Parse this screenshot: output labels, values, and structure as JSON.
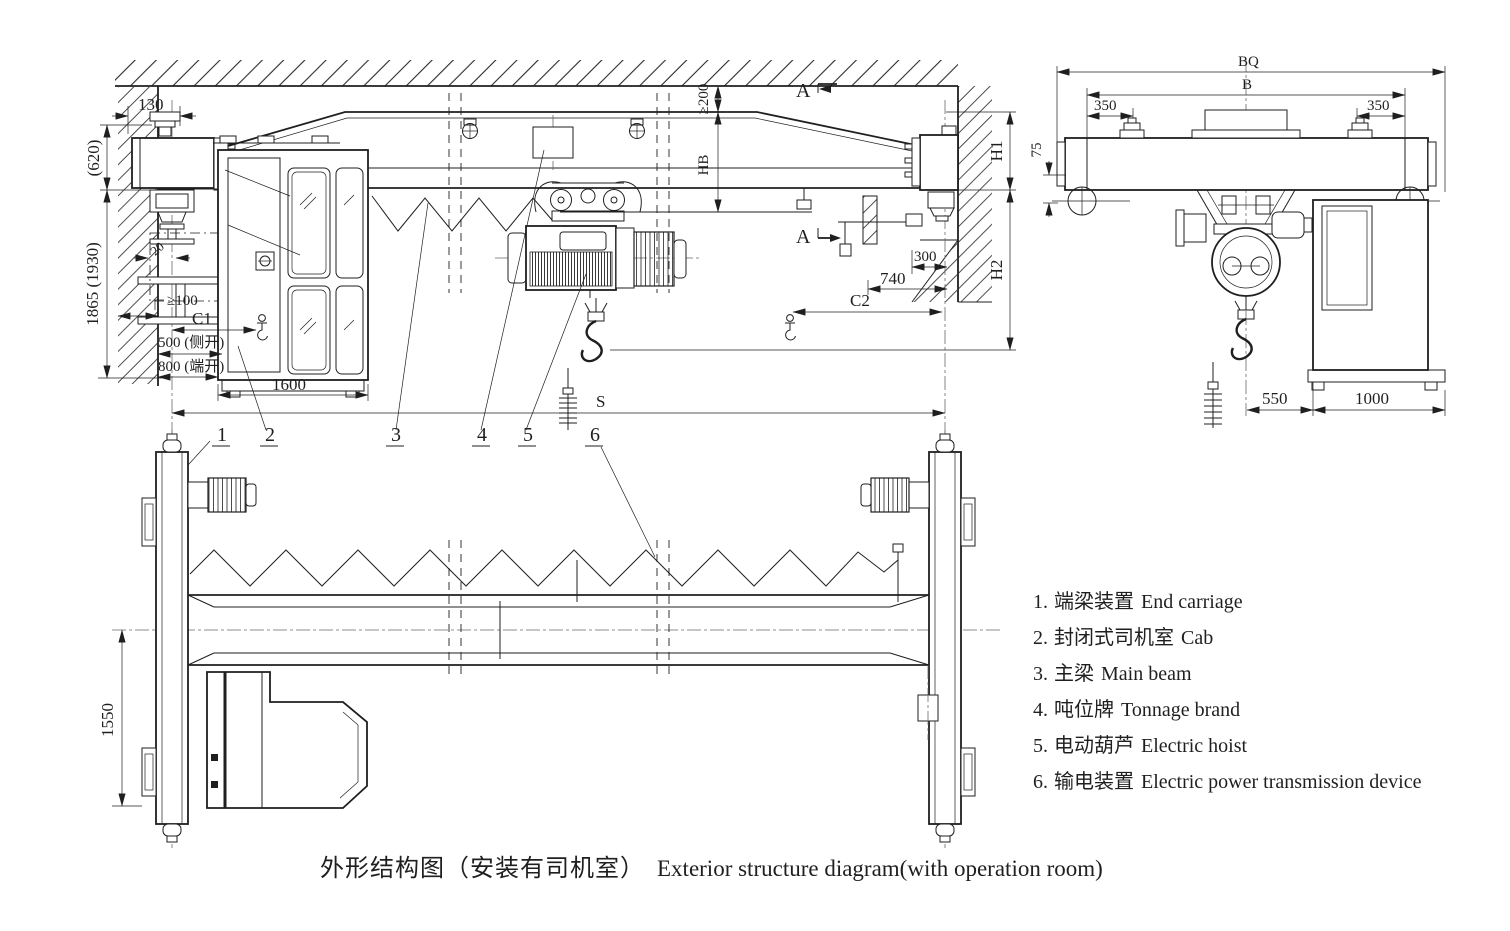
{
  "colors": {
    "ink": "#1f1f1f",
    "bg": "#ffffff"
  },
  "caption": {
    "zh": "外形结构图（安装有司机室）",
    "en": "Exterior structure diagram(with operation room)"
  },
  "legend": {
    "items": [
      {
        "num": "1.",
        "zh": "端梁装置",
        "en": "End carriage"
      },
      {
        "num": "2.",
        "zh": "封闭式司机室",
        "en": "Cab"
      },
      {
        "num": "3.",
        "zh": "主梁",
        "en": "Main beam"
      },
      {
        "num": "4.",
        "zh": "吨位牌",
        "en": "Tonnage brand"
      },
      {
        "num": "5.",
        "zh": "电动葫芦",
        "en": "Electric hoist"
      },
      {
        "num": "6.",
        "zh": "输电装置",
        "en": "Electric power transmission device"
      }
    ]
  },
  "front_view": {
    "dims": {
      "d130": "130",
      "d620": "(620)",
      "d1865": "1865 (1930)",
      "d20": "20",
      "dge100": "≥100",
      "dc1": "C1",
      "d500": "500 (侧开)",
      "d800": "800 (端开)",
      "d1600": "1600",
      "dge200": "≥200",
      "dhb": "HB",
      "dh1": "H1",
      "dh2": "H2",
      "d300": "300",
      "d740": "740",
      "dc2": "C2",
      "dspan": "S"
    },
    "section_marks": {
      "top": "A",
      "mid": "A"
    }
  },
  "side_view": {
    "dims": {
      "dbq": "BQ",
      "db": "B",
      "d350l": "350",
      "d350r": "350",
      "d75": "75",
      "d550": "550",
      "d1000": "1000"
    }
  },
  "plan_view": {
    "dims": {
      "d1550": "1550"
    }
  },
  "callouts": {
    "c1": "1",
    "c2": "2",
    "c3": "3",
    "c4": "4",
    "c5": "5",
    "c6": "6"
  }
}
